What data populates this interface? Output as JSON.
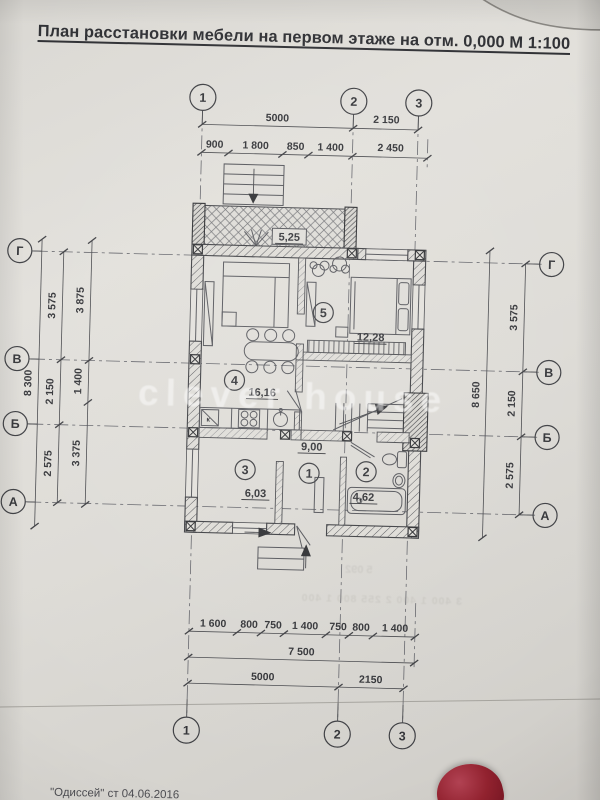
{
  "photo": {
    "title": "План расстановки мебели на первом этаже на отм. 0,000 М 1:100",
    "watermark": "clever house",
    "footer_note": "\"Одиссей\" ст 04.06.2016"
  },
  "axes": {
    "v1": "1",
    "v2": "2",
    "v3": "3",
    "hG": "Г",
    "hV": "В",
    "hB": "Б",
    "hA": "А"
  },
  "dims": {
    "top": {
      "d5000": "5000",
      "d2150": "2 150",
      "d900": "900",
      "d1800": "1 800",
      "d850": "850",
      "d1400": "1 400",
      "d2450": "2 450"
    },
    "left": {
      "total": "8 300",
      "g_v": "3 575",
      "v_b": "2 150",
      "b_a": "2 575",
      "inner_top": "3 875",
      "inner_mid": "1 400",
      "inner_bot": "3 375"
    },
    "right": {
      "total": "8 650",
      "g_v": "3 575",
      "v_b": "2 150",
      "b_a": "2 575"
    },
    "bottom": {
      "r1": [
        "1 600",
        "800",
        "750",
        "1 400",
        "750",
        "800",
        "1 400"
      ],
      "total_mid": "7 500",
      "d5000": "5000",
      "d2150": "2150"
    }
  },
  "rooms": {
    "porch": {
      "area": "5,25"
    },
    "r1": {
      "num": "1",
      "area": "9,00"
    },
    "r2": {
      "num": "2",
      "area": "4,62"
    },
    "r3": {
      "num": "3",
      "area": "6,03"
    },
    "r4": {
      "num": "4",
      "area": "16,16"
    },
    "r5": {
      "num": "5",
      "area": "12,28"
    }
  },
  "labels": {
    "kitchen_k": "к"
  },
  "ghost": {
    "line1": "5 092",
    "line2": "3 400  1 400  2 255  800  1 400"
  }
}
